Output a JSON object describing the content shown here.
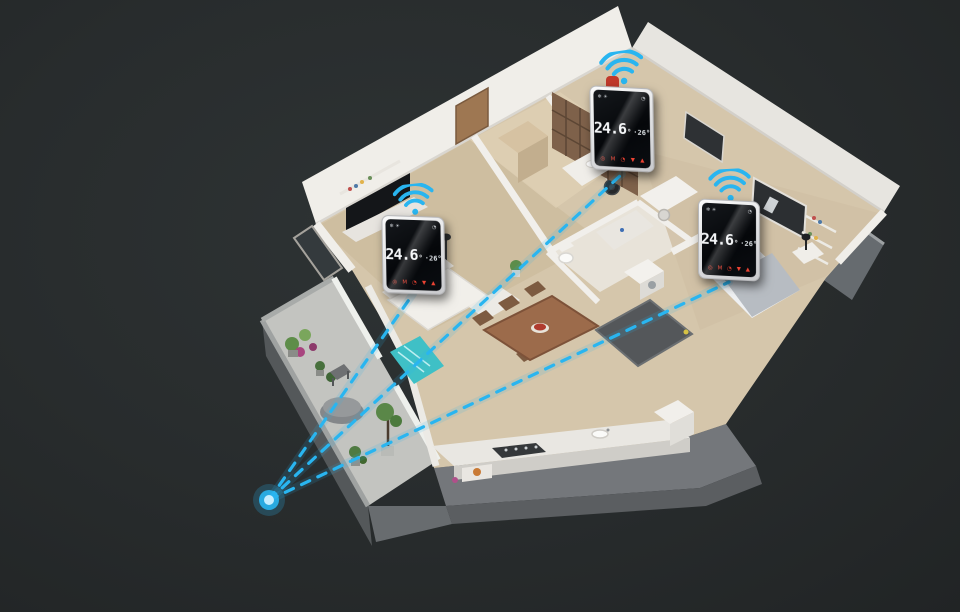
{
  "scene": {
    "background": "#272b2c",
    "accent": "#29b5f0",
    "floor_color": "#d5c6ab",
    "wall_color": "#f0eee9"
  },
  "hub": {
    "core_color": "#c6eeff"
  },
  "connections": {
    "count": 3,
    "style": "dashed"
  },
  "thermostats": [
    {
      "current_temp": "24.6",
      "degree": "°",
      "set_temp": "·26°",
      "status_left": "❄ ☀",
      "status_right": "◔",
      "buttons": [
        "◎",
        "M",
        "◔",
        "▼",
        "▲"
      ]
    },
    {
      "current_temp": "24.6",
      "degree": "°",
      "set_temp": "·26°",
      "status_left": "❄ ☀",
      "status_right": "◔",
      "buttons": [
        "◎",
        "M",
        "◔",
        "▼",
        "▲"
      ]
    },
    {
      "current_temp": "24.6",
      "degree": "°",
      "set_temp": "·26°",
      "status_left": "❄ ☀",
      "status_right": "◔",
      "buttons": [
        "◎",
        "M",
        "◔",
        "▼",
        "▲"
      ]
    }
  ],
  "icons": {
    "wifi": "wifi-signal-arcs",
    "hub": "glowing-dot",
    "power": "◎",
    "mode": "M",
    "clock": "◔",
    "down": "▼",
    "up": "▲"
  }
}
